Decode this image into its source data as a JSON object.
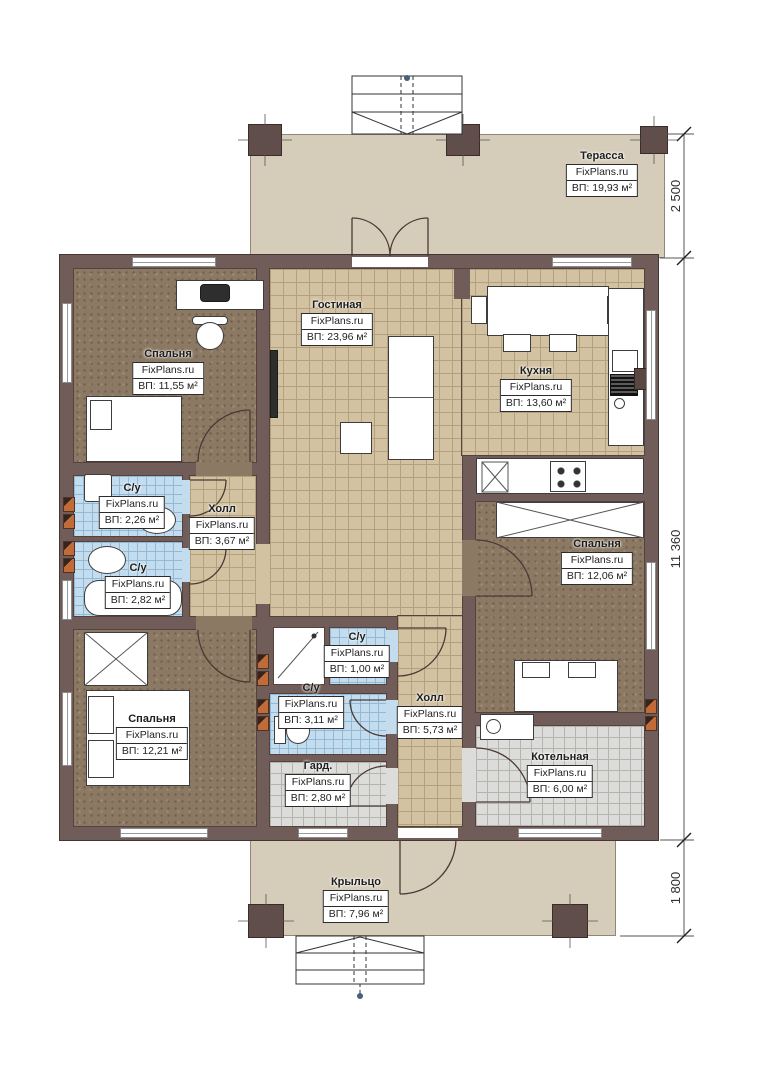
{
  "brand": "FixPlans.ru",
  "rooms": [
    {
      "id": "terrace",
      "name": "Терасса",
      "area": "ВП: 19,93 м²"
    },
    {
      "id": "bedroom-top-left",
      "name": "Спальня",
      "area": "ВП: 11,55 м²"
    },
    {
      "id": "living-room",
      "name": "Гостиная",
      "area": "ВП: 23,96 м²"
    },
    {
      "id": "kitchen",
      "name": "Кухня",
      "area": "ВП: 13,60 м²"
    },
    {
      "id": "bathroom-1",
      "name": "С/у",
      "area": "ВП: 2,26 м²"
    },
    {
      "id": "hall-1",
      "name": "Холл",
      "area": "ВП: 3,67 м²"
    },
    {
      "id": "bathroom-2",
      "name": "С/у",
      "area": "ВП: 2,82 м²"
    },
    {
      "id": "bedroom-right",
      "name": "Спальня",
      "area": "ВП: 12,06 м²"
    },
    {
      "id": "bathroom-3",
      "name": "С/у",
      "area": "ВП: 1,00 м²"
    },
    {
      "id": "bathroom-4",
      "name": "С/у",
      "area": "ВП: 3,11 м²"
    },
    {
      "id": "hall-2",
      "name": "Холл",
      "area": "ВП: 5,73 м²"
    },
    {
      "id": "bedroom-bottom-left",
      "name": "Спальня",
      "area": "ВП: 12,21 м²"
    },
    {
      "id": "wardrobe",
      "name": "Гард.",
      "area": "ВП: 2,80 м²"
    },
    {
      "id": "boiler-room",
      "name": "Котельная",
      "area": "ВП: 6,00 м²"
    },
    {
      "id": "porch",
      "name": "Крыльцо",
      "area": "ВП: 7,96 м²"
    }
  ],
  "dimensions": [
    {
      "id": "terrace-depth",
      "value": "2 500"
    },
    {
      "id": "house-length",
      "value": "11 360"
    },
    {
      "id": "porch-depth",
      "value": "1 800"
    }
  ],
  "colors": {
    "wall": "#705c58",
    "floor_tile_tan": "#d2c2a2",
    "floor_bedroom": "#8c7963",
    "floor_bath": "#c3dcee",
    "floor_utility": "#dcdcda",
    "deck": "#d6ccba",
    "vent_accent": "#c06b38"
  }
}
